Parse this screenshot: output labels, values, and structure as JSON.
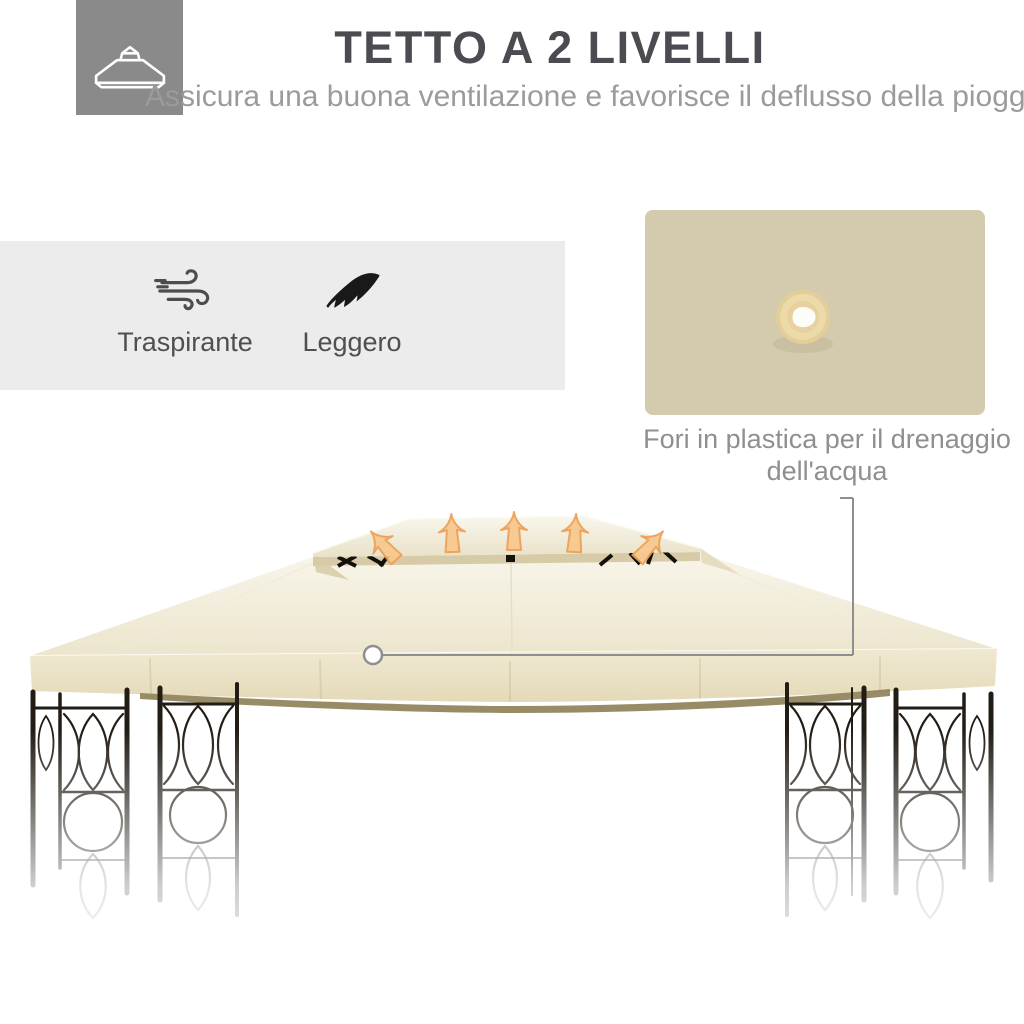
{
  "header": {
    "icon": "two-tier-roof-icon",
    "title": "TETTO A 2 LIVELLI",
    "subtitle": "Assicura una buona ventilazione e favorisce il deflusso della pioggia"
  },
  "features": {
    "items": [
      {
        "icon": "wind-icon",
        "label": "Traspirante"
      },
      {
        "icon": "feather-icon",
        "label": "Leggero"
      }
    ]
  },
  "inset": {
    "subject": "plastic-drainage-hole-closeup",
    "caption_lines": [
      "Fori in plastica per il drenaggio",
      "dell'acqua"
    ]
  },
  "photo": {
    "subject": "two-tier-gazebo-canopy-with-airflow-arrows",
    "airflow_arrow_count": 5
  },
  "colors": {
    "title": "#4b4b52",
    "subtitle": "#9b9b9b",
    "icon_box": "#8a8a8a",
    "feature_band": "#ececec",
    "feature_label": "#4f4f4f",
    "caption": "#8f8f8f",
    "inset_background": "#d4caad",
    "canopy": "#efe8d2",
    "canopy_fascia": "#e9e0c2",
    "frame": "#221c15",
    "arrow_fill": "#f8c88e",
    "arrow_stroke": "#ee9f54",
    "callout": "#8f8f8f"
  }
}
